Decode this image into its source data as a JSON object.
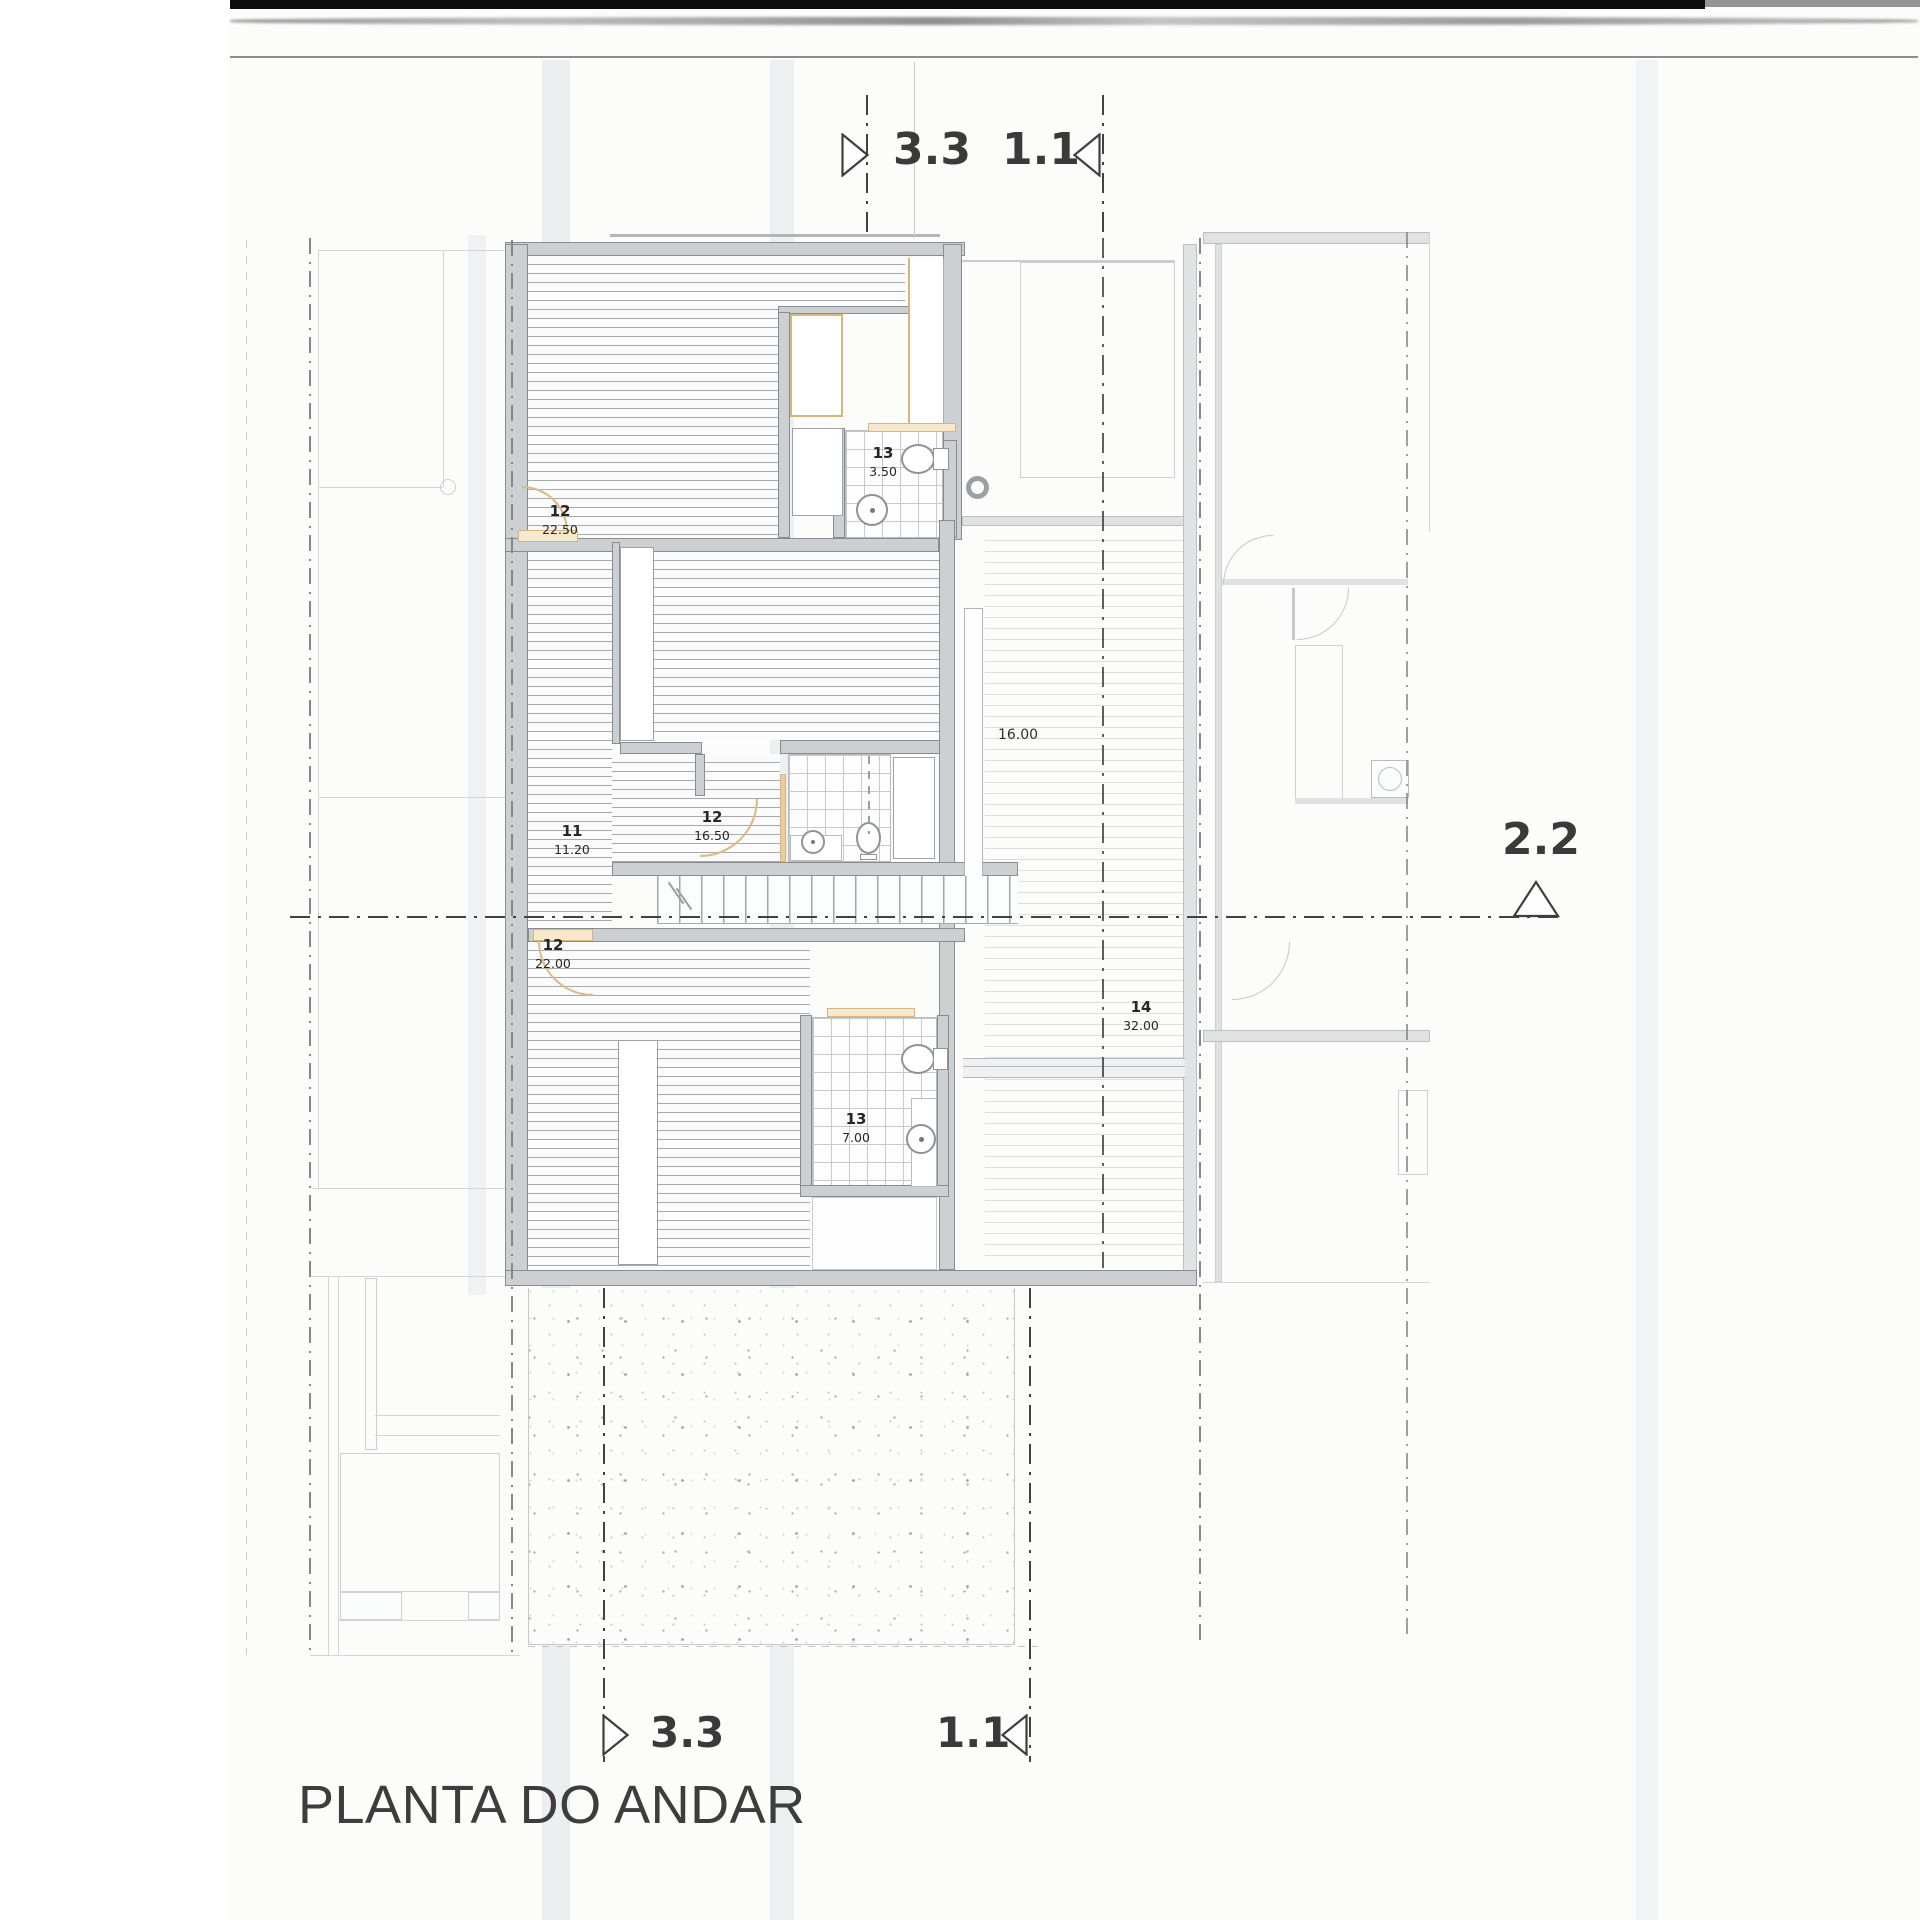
{
  "title": "PLANTA DO ANDAR",
  "section_markers": {
    "top_left": {
      "label": "3.3",
      "arrow": "right"
    },
    "top_right": {
      "label": "1.1",
      "arrow": "left"
    },
    "right": {
      "label": "2.2",
      "arrow": "up"
    },
    "bottom_left": {
      "label": "3.3",
      "arrow": "right"
    },
    "bottom_right": {
      "label": "1.1",
      "arrow": "left"
    }
  },
  "rooms": {
    "bedroom_top": {
      "number": "12",
      "area": "22.50"
    },
    "bathroom_top": {
      "number": "13",
      "area": "3.50"
    },
    "bedroom_middle": {
      "number": "12",
      "area": "16.50"
    },
    "hall": {
      "number": "11",
      "area": "11.20"
    },
    "bedroom_bottom": {
      "number": "12",
      "area": "22.00"
    },
    "living_void": {
      "number": "14",
      "area": "32.00"
    },
    "bathroom_bottom": {
      "number": "13",
      "area": "7.00"
    }
  },
  "dimensions": {
    "living_void_width": "16.00"
  },
  "colors": {
    "wall_fill": "#cdd0d2",
    "wall_edge": "#888c8f",
    "accent_tan": "#d9b47e",
    "section_line": "#424242",
    "ink": "#262626",
    "paper": "#fcfcfb"
  },
  "fixtures": [
    "toilet",
    "sink",
    "column",
    "stairs",
    "wardrobe",
    "door-swing",
    "washing-machine"
  ]
}
